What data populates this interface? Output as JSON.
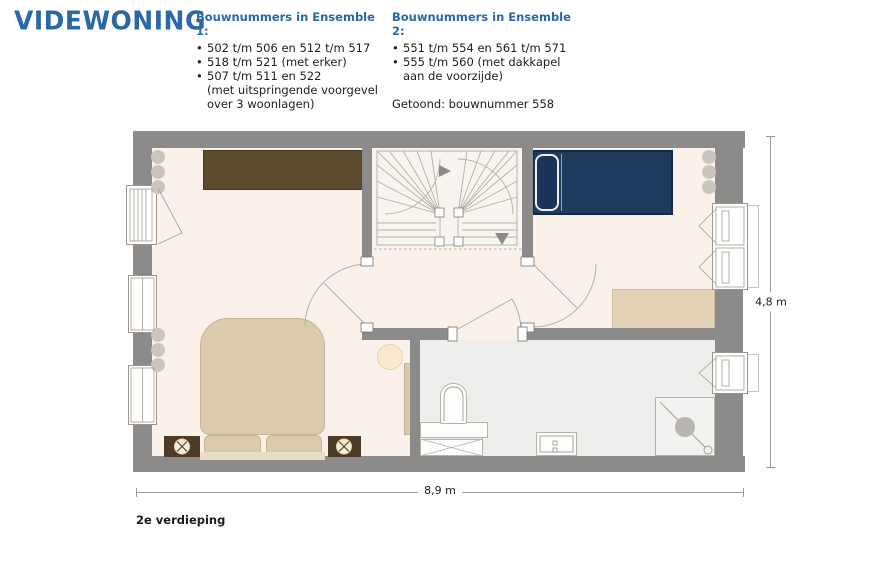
{
  "brand": {
    "logo_text": "VIDEWONING"
  },
  "ensemble1": {
    "title": "Bouwnummers in Ensemble 1:",
    "lines": [
      {
        "bullet": "•",
        "text": "502 t/m 506 en 512 t/m 517"
      },
      {
        "bullet": "•",
        "text": "518 t/m 521 (met erker)"
      },
      {
        "bullet": "•",
        "text": "507 t/m 511 en 522"
      },
      {
        "bullet": "",
        "text": "(met uitspringende voorgevel"
      },
      {
        "bullet": "",
        "text": "over 3 woonlagen)"
      }
    ]
  },
  "ensemble2": {
    "title": "Bouwnummers in Ensemble 2:",
    "lines": [
      {
        "bullet": "•",
        "text": "551 t/m 554 en 561 t/m 571"
      },
      {
        "bullet": "•",
        "text": "555 t/m 560 (met dakkapel"
      },
      {
        "bullet": "",
        "text": "aan de voorzijde)"
      }
    ],
    "shown_label": "Getoond: bouwnummer 558"
  },
  "floorplan": {
    "floor_label": "2e verdieping",
    "width_dimension": "8,9 m",
    "height_dimension": "4,8 m"
  },
  "colors": {
    "brand_blue": "#2b68a7",
    "wall_gray": "#8c8b89",
    "floor_cream": "#faf2ea",
    "floor_bathroom": "#eeeeec",
    "wardrobe_brown": "#5c4a2e",
    "nightstand_brown": "#4e3b26",
    "bed_navy": "#1e3a5c",
    "bed_beige": "#ddcbaf",
    "desk_beige": "#e3d2b6",
    "stool_cream": "#fbe8cf"
  }
}
